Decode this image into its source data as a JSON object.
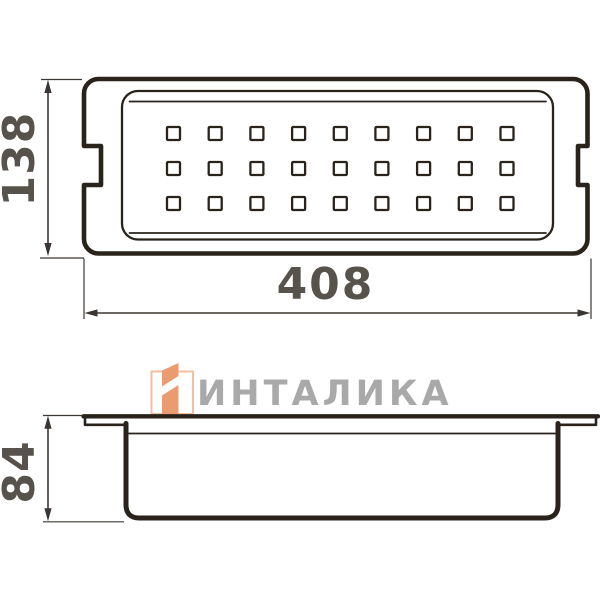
{
  "dimensions": {
    "top_width": "408",
    "top_height": "138",
    "side_height": "84"
  },
  "top_view": {
    "hole_grid": {
      "rows": 3,
      "columns": 9
    }
  },
  "watermark": {
    "brand": "ИНТАЛИКА"
  },
  "colors": {
    "background": "#ffffff",
    "outline": "#29231c",
    "dim_text": "#57524c",
    "dim_line": "#3b3631",
    "brand_text": "#a9a9a9",
    "brand_accent": "#eb9b70",
    "brand_accent_light": "#f3bfa0"
  }
}
